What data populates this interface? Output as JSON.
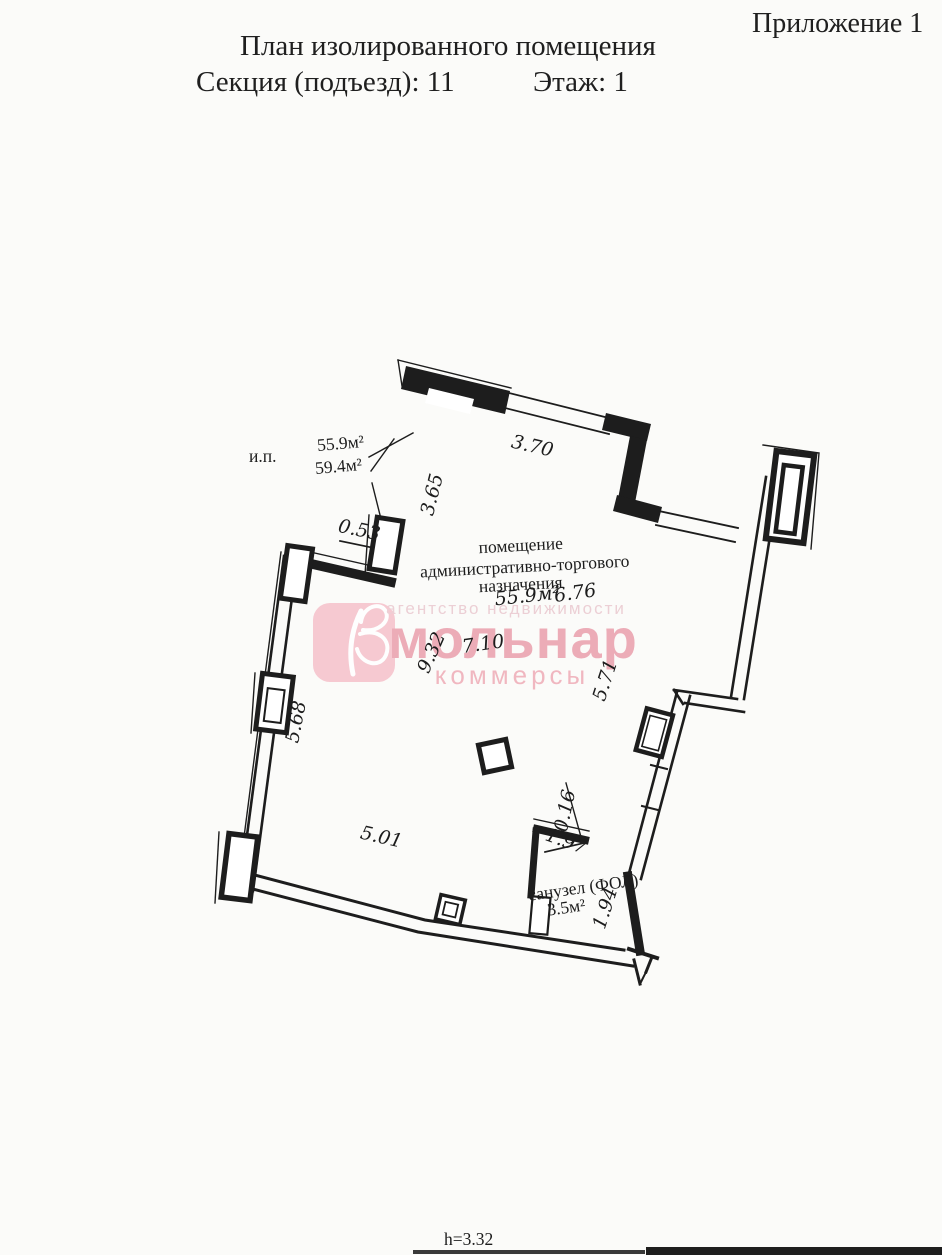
{
  "header": {
    "appendix": "Приложение 1",
    "title": "План изолированного помещения",
    "section": "Секция (подъезд): 11",
    "floor": "Этаж: 1"
  },
  "plan": {
    "ip_label": "и.п.",
    "area_upper": "55.9м²",
    "area_lower": "59.4м²",
    "room": {
      "line1": "помещение",
      "line2": "административно-торгового",
      "line3": "назначения",
      "area": "55.9м²"
    },
    "bathroom": {
      "name": "санузел (ФОЛ)",
      "area": "3.5м²"
    },
    "dims": {
      "d370": "3.70",
      "d365": "3.65",
      "d053": "0.53",
      "d568": "5.68",
      "d501": "5.01",
      "d932": "9.32",
      "d710": "7.10",
      "d676": "6.76",
      "d571": "5.71",
      "d016": "0.16",
      "d197": "1.97",
      "d194": "1.94"
    },
    "height_note": "h=3.32"
  },
  "watermark": {
    "agency": "агентство недвижимости",
    "brand": "мольнар",
    "subtitle": "коммерсы",
    "colors": {
      "box": "#f6c5ce",
      "brand": "#eba6b2",
      "subtitle": "#f0b2bc",
      "agency": "#ebccd2"
    }
  },
  "colors": {
    "ink": "#1d1d1d",
    "paper": "#fbfbf9"
  }
}
